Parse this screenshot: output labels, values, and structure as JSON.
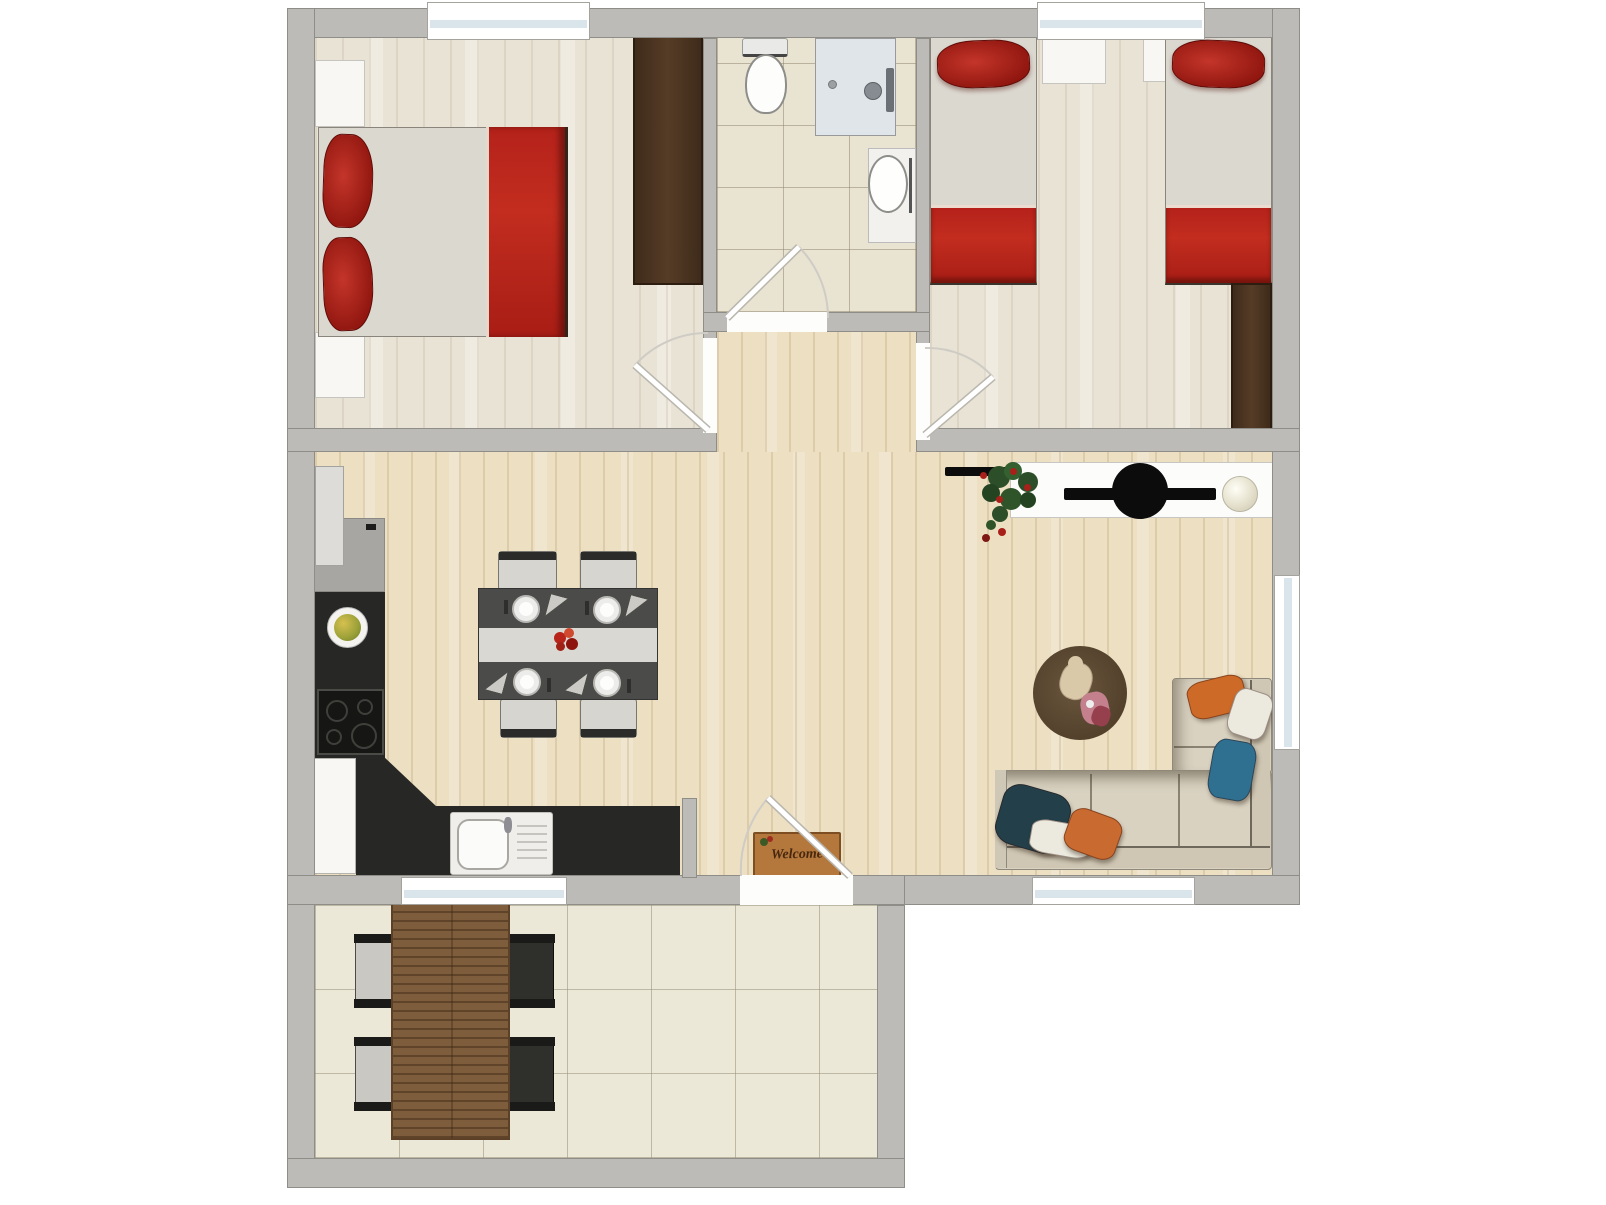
{
  "labels": {
    "welcome_mat": "Welcome"
  },
  "palette": {
    "wall_gray": "#bdbbb7",
    "accent_red": "#bf2318",
    "wood_pale": "#e9e3d5",
    "wood_warm": "#ecdfc2",
    "bath_tile": "#e9e3d2",
    "terrace_tile": "#ebe8d7",
    "counter_dark": "#272725",
    "wardrobe_brown": "#4b3523",
    "sofa_beige": "#d9d2c1",
    "rug_brown": "#5a4530",
    "terrace_table_brown": "#7e5d3c",
    "mat_tan": "#b4773c",
    "pillow_orange": "#cd6a28",
    "pillow_blue": "#2f6f8f"
  },
  "floorplan": {
    "type": "apartment-top-view",
    "rooms": [
      {
        "name": "bedroom-double",
        "furniture": [
          "double-bed",
          "red-pillow",
          "red-pillow",
          "red-blanket",
          "nightstand",
          "nightstand",
          "wardrobe"
        ]
      },
      {
        "name": "bathroom",
        "furniture": [
          "toilet",
          "shower",
          "washbasin"
        ]
      },
      {
        "name": "bedroom-twin",
        "furniture": [
          "single-bed",
          "single-bed",
          "nightstand",
          "nightstand",
          "wardrobe"
        ]
      },
      {
        "name": "kitchen-living-room",
        "furniture": [
          "fridge",
          "counter",
          "cooktop",
          "kitchen-sink",
          "dining-table",
          "dining-chair",
          "dining-chair",
          "dining-chair",
          "dining-chair",
          "sideboard",
          "plant",
          "sphere-lamp",
          "round-rug",
          "teddy-bear",
          "corner-sofa",
          "welcome-mat"
        ]
      },
      {
        "name": "terrace",
        "furniture": [
          "wooden-table",
          "terrace-chair",
          "terrace-chair",
          "terrace-chair",
          "terrace-chair"
        ]
      }
    ],
    "doors": [
      "bedroom-double-door",
      "bathroom-door",
      "bedroom-twin-door",
      "terrace-door"
    ],
    "windows_count": 5
  }
}
